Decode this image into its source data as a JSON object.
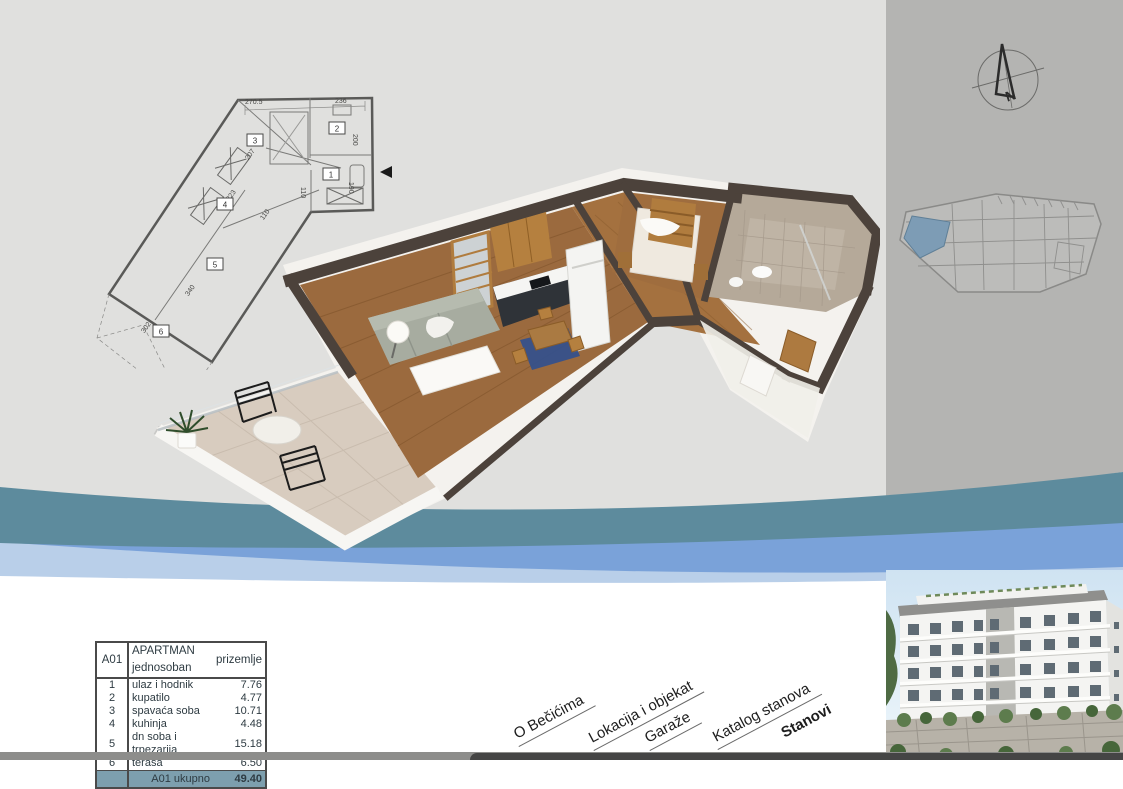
{
  "table": {
    "code": "A01",
    "title": "APARTMAN jednosoban",
    "subtitle": "prizemlje",
    "rows": [
      {
        "num": "1",
        "name": "ulaz i hodnik",
        "area": "7.76"
      },
      {
        "num": "2",
        "name": "kupatilo",
        "area": "4.77"
      },
      {
        "num": "3",
        "name": "spavaća soba",
        "area": "10.71"
      },
      {
        "num": "4",
        "name": "kuhinja",
        "area": "4.48"
      },
      {
        "num": "5",
        "name": "dn soba i trpezarija",
        "area": "15.18"
      },
      {
        "num": "6",
        "name": "terasa",
        "area": "6.50"
      }
    ],
    "total_label": "A01 ukupno",
    "total_value": "49.40"
  },
  "nav": {
    "items": [
      {
        "label": "O Bečićima",
        "active": false
      },
      {
        "label": "Lokacija i objekat",
        "active": false
      },
      {
        "label": "Garaže",
        "active": false
      },
      {
        "label": "Katalog stanova",
        "active": false
      },
      {
        "label": "Stanovi",
        "active": true
      }
    ]
  },
  "floor_plan": {
    "rooms": [
      "1",
      "2",
      "3",
      "4",
      "5",
      "6"
    ],
    "dims": {
      "top": "270.5",
      "d236": "236",
      "d200": "200",
      "d190": "190",
      "d110a": "110",
      "d207": "207",
      "d223": "223",
      "d110b": "110",
      "d340": "340",
      "d302": "302"
    }
  },
  "compass": {
    "north": "N"
  },
  "colors": {
    "wave_teal": "#5d8b9d",
    "wave_blue": "#7aa2d9",
    "wave_pale": "#b9cfe9",
    "table_total_bg": "#7d9fae",
    "siteplan_highlight": "#7d9cb5",
    "bg_left": "#e0e0de",
    "bg_right": "#b4b4b2"
  }
}
